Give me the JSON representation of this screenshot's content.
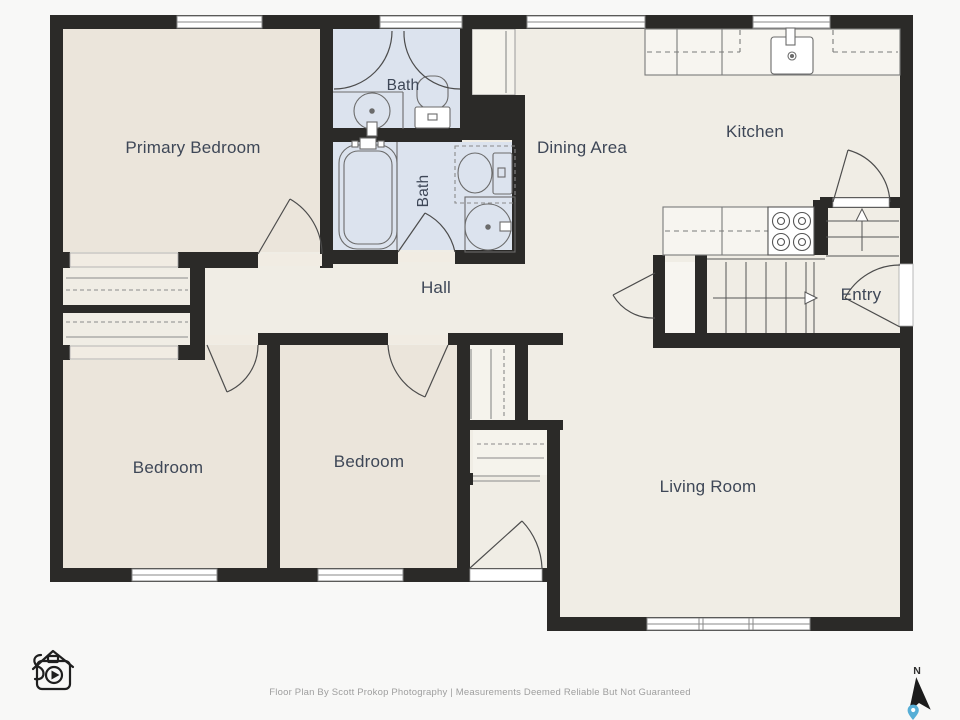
{
  "plan": {
    "rooms": {
      "primary_bedroom": "Primary Bedroom",
      "bath_upper": "Bath",
      "bath_lower": "Bath",
      "dining": "Dining Area",
      "kitchen": "Kitchen",
      "hall": "Hall",
      "entry": "Entry",
      "bedroom_left": "Bedroom",
      "bedroom_middle": "Bedroom",
      "living_room": "Living Room"
    },
    "colors": {
      "wall": "#2b2a28",
      "floor": "#f0ede5",
      "bedroom_floor": "#ebe5db",
      "bath_floor": "#dce3ee",
      "counter": "#f7f5f0",
      "label_text": "#3e4757",
      "pin_accent": "#56aed6",
      "background": "#f8f8f7"
    },
    "icons": {
      "logo": "house-camera-logo-icon",
      "compass_arrow": "north-arrow-icon",
      "map_pin": "location-pin-icon"
    }
  },
  "compass": {
    "north_label": "N"
  },
  "footer": {
    "credit": "Floor Plan By Scott Prokop Photography | Measurements Deemed Reliable But Not Guaranteed"
  }
}
